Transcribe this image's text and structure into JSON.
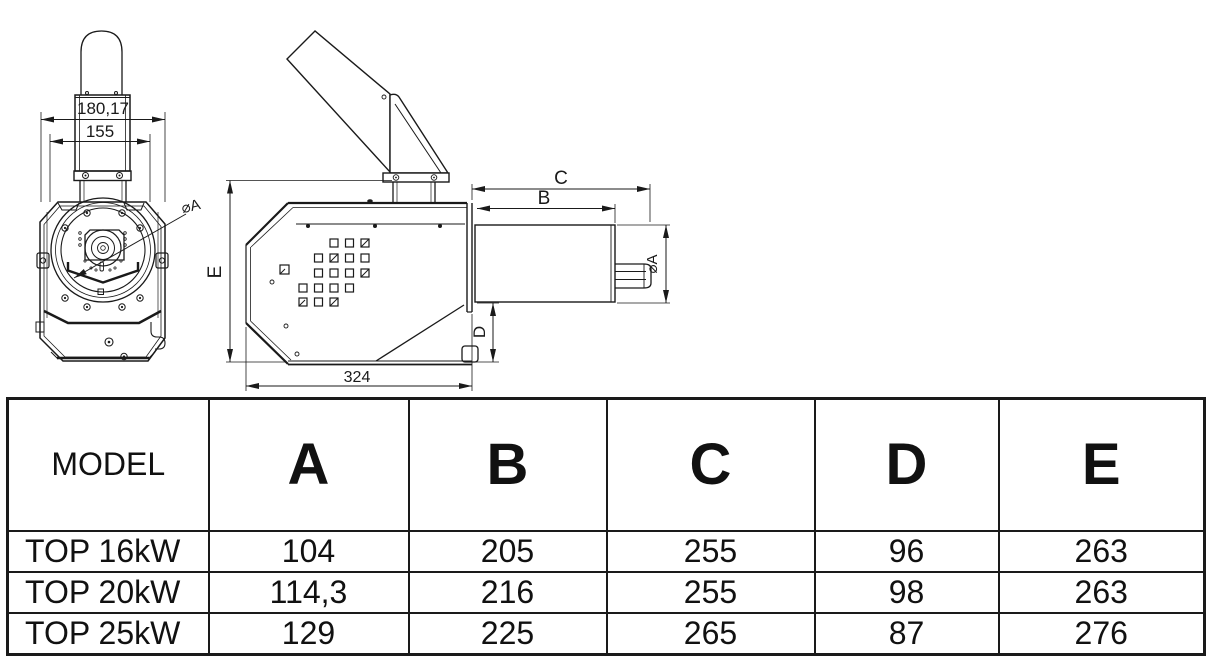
{
  "drawing": {
    "front_view": {
      "dim_width_outer": "180,17",
      "dim_width_inner": "155",
      "dim_diameter": "⌀A"
    },
    "side_view": {
      "dim_c": "C",
      "dim_b": "B",
      "dim_diameter": "⌀A",
      "dim_d": "D",
      "dim_e": "E",
      "dim_length": "324"
    }
  },
  "table": {
    "columns": [
      "MODEL",
      "A",
      "B",
      "C",
      "D",
      "E"
    ],
    "rows": [
      {
        "model": "TOP 16kW",
        "a": "104",
        "b": "205",
        "c": "255",
        "d": "96",
        "e": "263"
      },
      {
        "model": "TOP 20kW",
        "a": "114,3",
        "b": "216",
        "c": "255",
        "d": "98",
        "e": "263"
      },
      {
        "model": "TOP 25kW",
        "a": "129",
        "b": "225",
        "c": "265",
        "d": "87",
        "e": "276"
      }
    ]
  }
}
